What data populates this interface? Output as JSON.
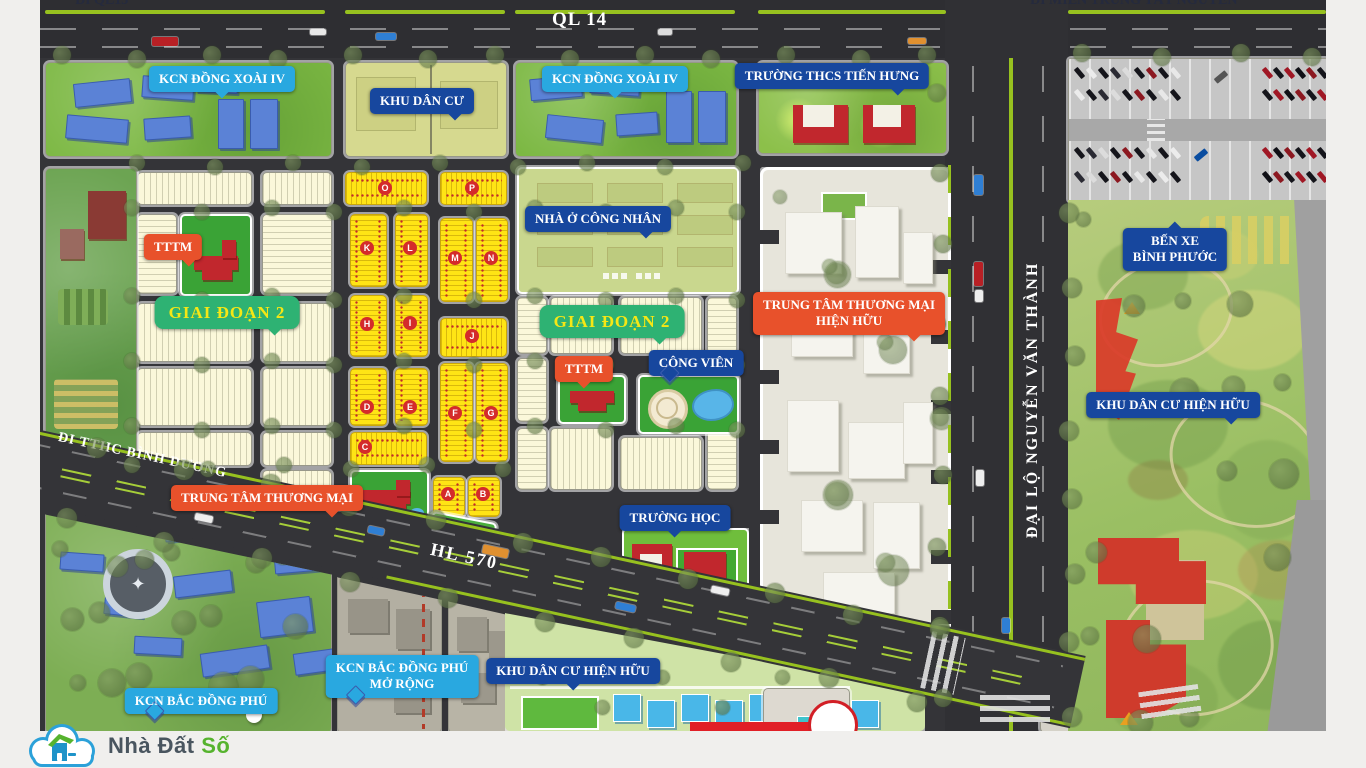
{
  "page": {
    "background": "#f0efed"
  },
  "map": {
    "road_labels": {
      "di_ql13": {
        "text": "ĐI QL13"
      },
      "ql14": {
        "text": "QL 14"
      },
      "di_mien_trung": {
        "text": "ĐI MIỀN TRUNG TÂY NGUYÊN"
      },
      "dai_lo": {
        "text": "ĐẠI LỘ NGUYỄN VĂN THÀNH"
      },
      "di_tthc": {
        "text": "ĐI TTHC BÌNH DƯƠNG"
      },
      "hl570": {
        "text": "HL 570"
      }
    },
    "callouts": [
      {
        "id": "kcn-dong-xoai-iv-west",
        "style": "lightblue",
        "lines": [
          "KCN ĐỒNG XOÀI IV"
        ]
      },
      {
        "id": "khu-dan-cu",
        "style": "darkblue",
        "lines": [
          "KHU DÂN CƯ"
        ]
      },
      {
        "id": "kcn-dong-xoai-iv-east",
        "style": "lightblue",
        "lines": [
          "KCN ĐỒNG XOÀI IV"
        ]
      },
      {
        "id": "truong-thcs-tien-hung",
        "style": "darkblue",
        "lines": [
          "TRƯỜNG THCS TIẾN HƯNG"
        ]
      },
      {
        "id": "tttm-phase2-west",
        "style": "orange",
        "lines": [
          "TTTM"
        ]
      },
      {
        "id": "giai-doan-2-west",
        "style": "green",
        "lines": [
          "GIAI ĐOẠN 2"
        ]
      },
      {
        "id": "nha-o-cong-nhan",
        "style": "darkblue",
        "lines": [
          "NHÀ Ở CÔNG NHÂN"
        ]
      },
      {
        "id": "giai-doan-2-center",
        "style": "green",
        "lines": [
          "GIAI ĐOẠN 2"
        ]
      },
      {
        "id": "tttm-phase2-center",
        "style": "orange",
        "lines": [
          "TTTM"
        ]
      },
      {
        "id": "cong-vien",
        "style": "darkblue",
        "lines": [
          "CÔNG VIÊN"
        ]
      },
      {
        "id": "trung-tam-thuong-mai-hien-huu",
        "style": "orange",
        "lines": [
          "TRUNG TÂM THƯƠNG MẠI",
          "HIỆN HỮU"
        ]
      },
      {
        "id": "ben-xe-binh-phuoc",
        "style": "darkblue",
        "lines": [
          "BẾN XE",
          "BÌNH PHƯỚC"
        ]
      },
      {
        "id": "khu-dan-cu-hien-huu-east",
        "style": "darkblue",
        "lines": [
          "KHU DÂN CƯ HIỆN HỮU"
        ]
      },
      {
        "id": "trung-tam-thuong-mai",
        "style": "orange",
        "lines": [
          "TRUNG TÂM THƯƠNG MẠI"
        ]
      },
      {
        "id": "truong-hoc",
        "style": "darkblue",
        "lines": [
          "TRƯỜNG HỌC"
        ]
      },
      {
        "id": "kcn-bac-dong-phu",
        "style": "lightblue",
        "lines": [
          "KCN BẮC ĐỒNG PHÚ"
        ]
      },
      {
        "id": "kcn-bac-dong-phu-mo-rong",
        "style": "lightblue",
        "lines": [
          "KCN BẮC ĐỒNG PHÚ",
          "MỞ RỘNG"
        ]
      },
      {
        "id": "khu-dan-cu-hien-huu-south",
        "style": "darkblue",
        "lines": [
          "KHU DÂN CƯ HIỆN HỮU"
        ]
      }
    ],
    "block_letters": [
      "O",
      "P",
      "K",
      "L",
      "M",
      "N",
      "H",
      "I",
      "J",
      "D",
      "E",
      "F",
      "G",
      "C",
      "A",
      "B"
    ],
    "colors": {
      "road": "#343438",
      "road_line_green": "#97c11f",
      "lot_cream": "#fbf8da",
      "lot_yellow": "#ffe415",
      "callout_lightblue": "#29a8e0",
      "callout_darkblue": "#17479e",
      "callout_orange": "#e8512b",
      "phase_banner_green": "#2eb273",
      "phase_banner_text": "#f6e715",
      "marker_red": "#d42b2b"
    }
  },
  "footer": {
    "logo_icon": "cloud-house-icon",
    "logo_text_primary": "Nhà Đất",
    "logo_text_accent": "Số"
  }
}
